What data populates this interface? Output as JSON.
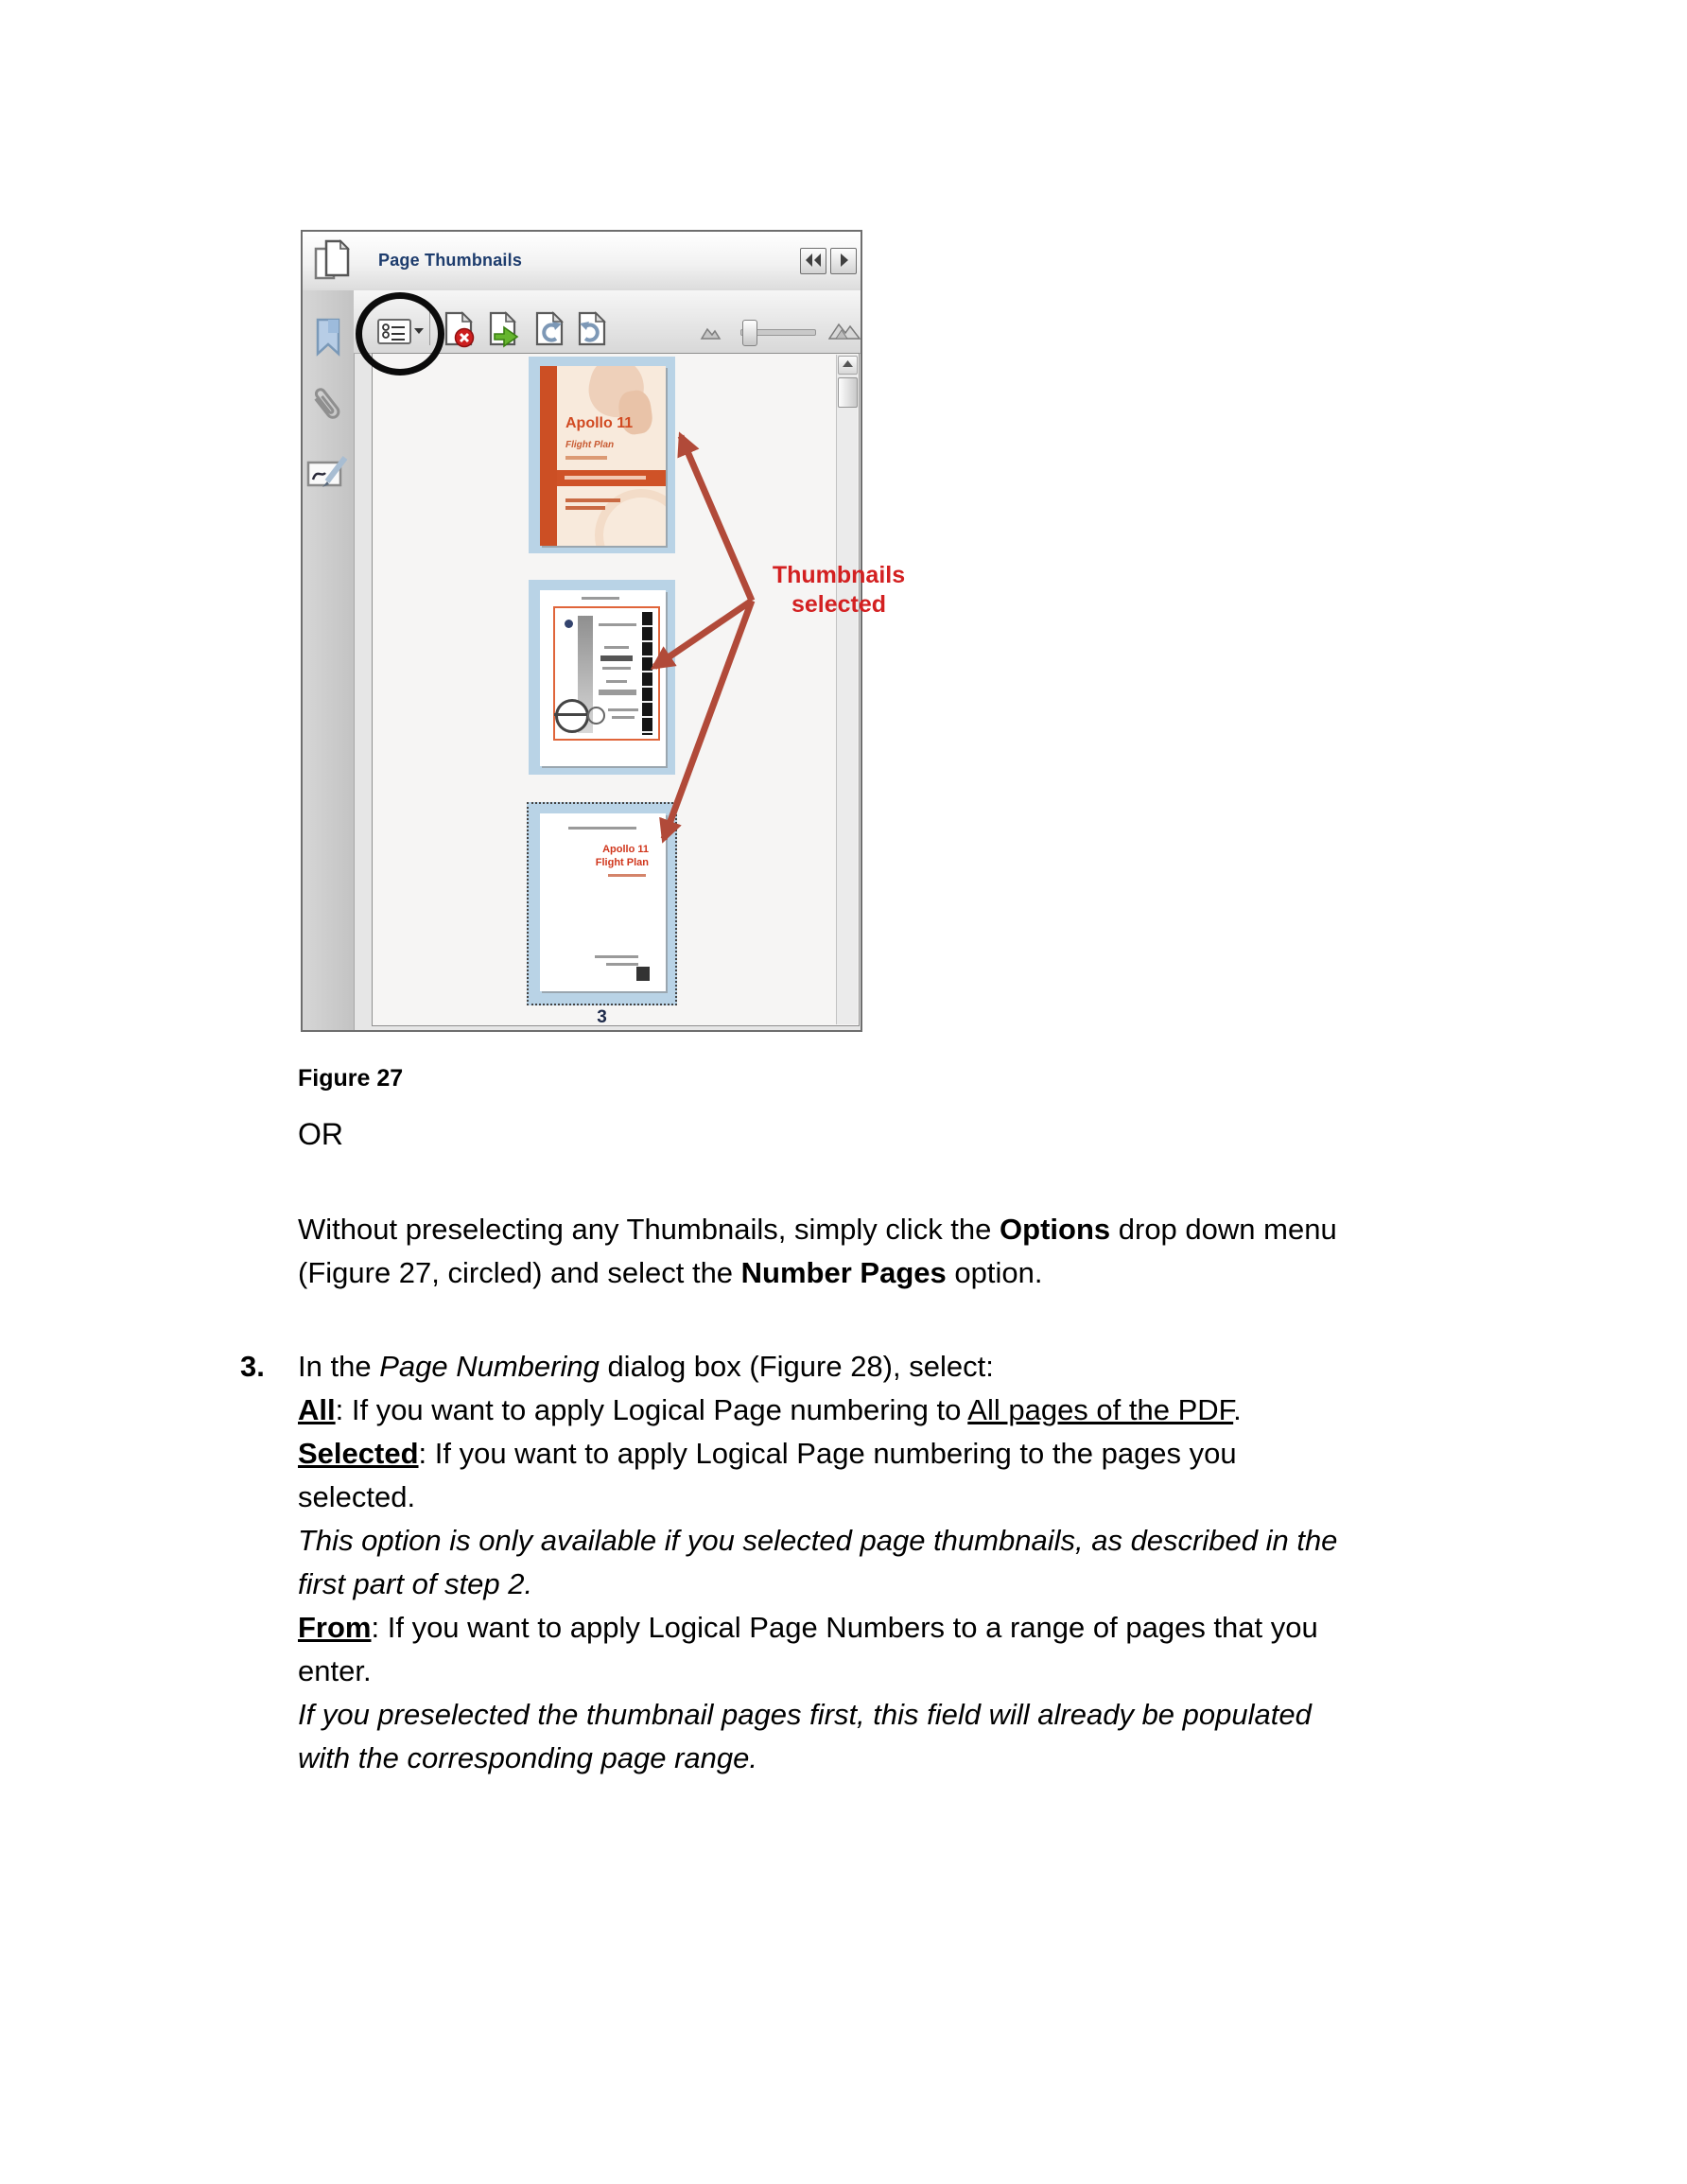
{
  "figure": {
    "panel_title": "Page Thumbnails",
    "page_labels": [
      "1",
      "2",
      "3"
    ],
    "thumb1_title": "Apollo 11",
    "thumb1_subtitle": "Flight Plan",
    "thumb3_title": "Apollo 11",
    "thumb3_subtitle": "Flight Plan",
    "annotation_line1": "Thumbnails",
    "annotation_line2": "selected",
    "icons": {
      "pages": "two overlapping page outlines",
      "bookmark": "blue bookmark ribbon",
      "paperclip": "attachment paperclip",
      "signature": "signature pad with pen",
      "options_menu": "list glyph with dropdown arrow",
      "delete_pages": "page with red x badge",
      "extract_pages": "page with green arrow",
      "rotate_ccw": "page with counterclockwise arrow",
      "rotate_cw": "page with clockwise arrow",
      "zoom_out": "small mountain",
      "zoom_in": "large mountains",
      "collapse": "double left arrow",
      "expand": "right arrow",
      "scroll_up": "up triangle"
    },
    "colors": {
      "selection_blue": "#b9d3e6",
      "accent_orange": "#cf5227",
      "annotation_red": "#d32021",
      "arrow_red": "#b14a39",
      "title_blue": "#1d3c6d"
    }
  },
  "caption": "Figure 27",
  "or_label": "OR",
  "para": {
    "l1a": "Without preselecting any Thumbnails, simply click the ",
    "l1b": "Options",
    "l1c": " drop down menu",
    "l2a": "(Figure 27, circled) and select the ",
    "l2b": "Number Pages",
    "l2c": " option."
  },
  "step3": {
    "number": "3.",
    "l1a": "In the ",
    "l1b": "Page Numbering",
    "l1c": " dialog box (Figure 28), select:",
    "l2a": "All",
    "l2b": ": If you want to apply Logical Page numbering to ",
    "l2c": "All pages of the PDF",
    "l2d": ".",
    "l3a": "Selected",
    "l3b": ": If you want to apply Logical Page numbering to the pages you",
    "l4": "selected.",
    "l5": "This option is only available if you selected page thumbnails, as described in the",
    "l6": "first part of step 2.",
    "l7a": "From",
    "l7b": ": If you want to apply Logical Page Numbers to a range of pages that you",
    "l8": "enter.",
    "l9": "If you preselected the thumbnail pages first, this field will already be populated",
    "l10": "with the corresponding page range."
  }
}
